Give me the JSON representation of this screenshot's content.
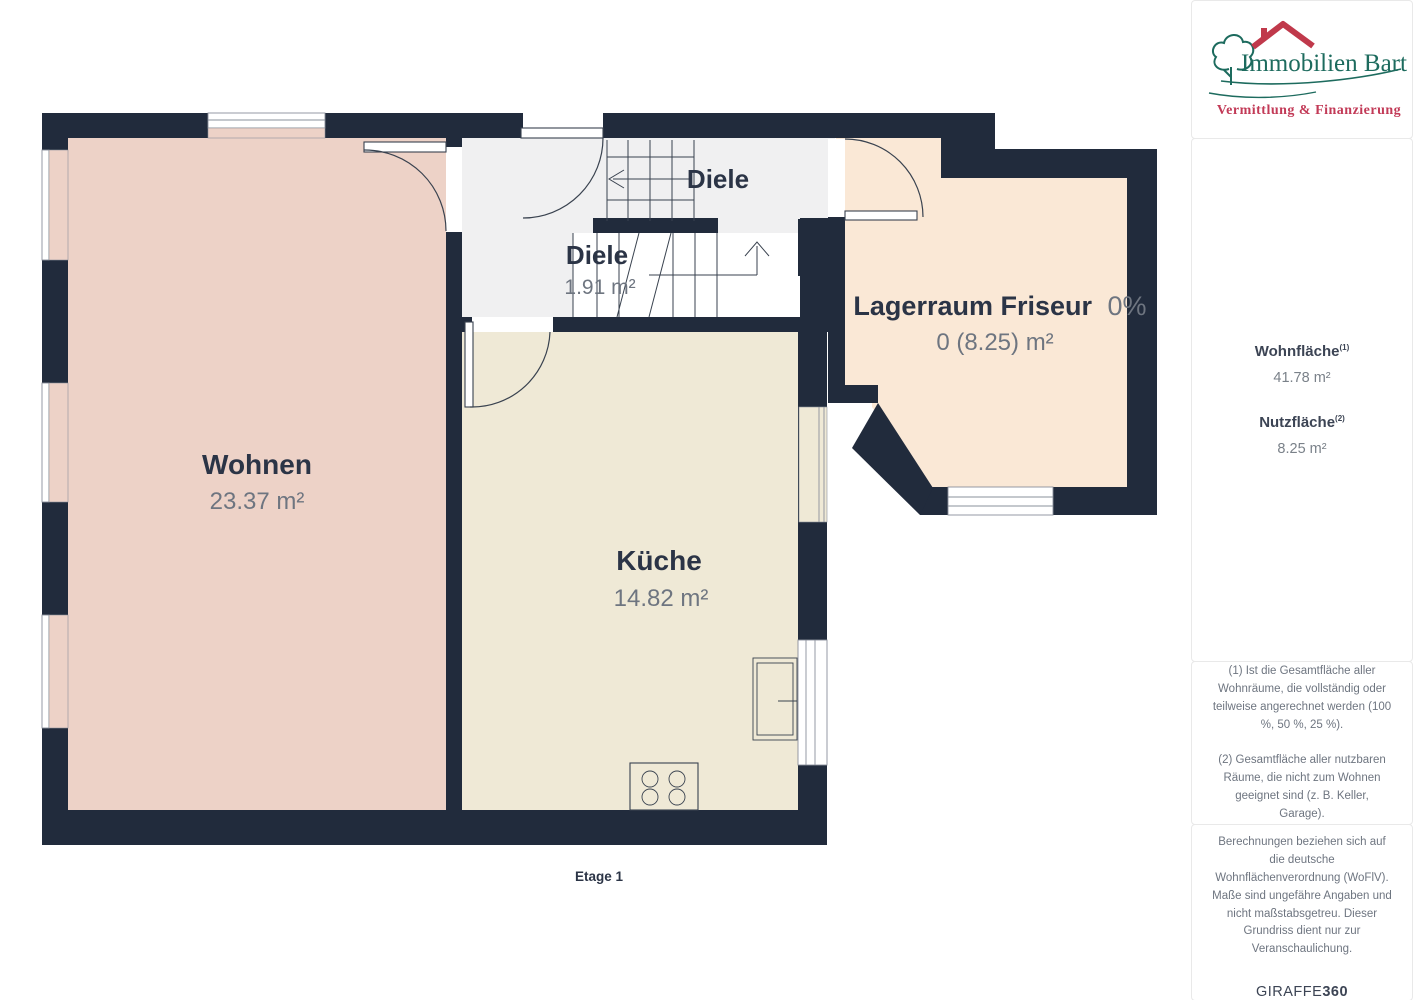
{
  "floorplan": {
    "floor_label": "Etage 1",
    "rooms": {
      "wohnen": {
        "name": "Wohnen",
        "area": "23.37 m²"
      },
      "kueche": {
        "name": "Küche",
        "area": "14.82 m²"
      },
      "diele_upper": {
        "name": "Diele"
      },
      "diele_lower": {
        "name": "Diele",
        "area": "1.91 m²"
      },
      "lagerraum": {
        "name": "Lagerraum Friseur",
        "percent": "0%",
        "area": "0 (8.25) m²"
      }
    },
    "colors": {
      "wall": "#212b3c",
      "room_wohnen": "#edd2c7",
      "room_kueche": "#efe9d6",
      "room_diele": "#f0f0f1",
      "room_lagerraum": "#fae8d6"
    }
  },
  "sidebar": {
    "logo": {
      "brand": "Immobilien Bart",
      "tagline": "Vermittlung & Finanzierung",
      "brand_color": "#1d6b5e",
      "tagline_color": "#c23a57"
    },
    "metrics": [
      {
        "label": "Wohnfläche",
        "footnote_ref": "(1)",
        "value": "41.78 m²"
      },
      {
        "label": "Nutzfläche",
        "footnote_ref": "(2)",
        "value": "8.25 m²"
      }
    ],
    "footnotes": [
      "(1) Ist die Gesamtfläche aller Wohnräume, die vollständig oder teilweise angerechnet werden (100 %, 50 %, 25 %).",
      "(2) Gesamtfläche aller nutzbaren Räume, die nicht zum Wohnen geeignet sind (z. B. Keller, Garage)."
    ],
    "disclaimer": "Berechnungen beziehen sich auf die deutsche Wohnflächenverordnung (WoFlV). Maße sind ungefähre Angaben und nicht maßstabsgetreu. Dieser Grundriss dient nur zur Veranschaulichung.",
    "watermark": {
      "brand": "GIRAFFE",
      "suffix": "360"
    }
  }
}
